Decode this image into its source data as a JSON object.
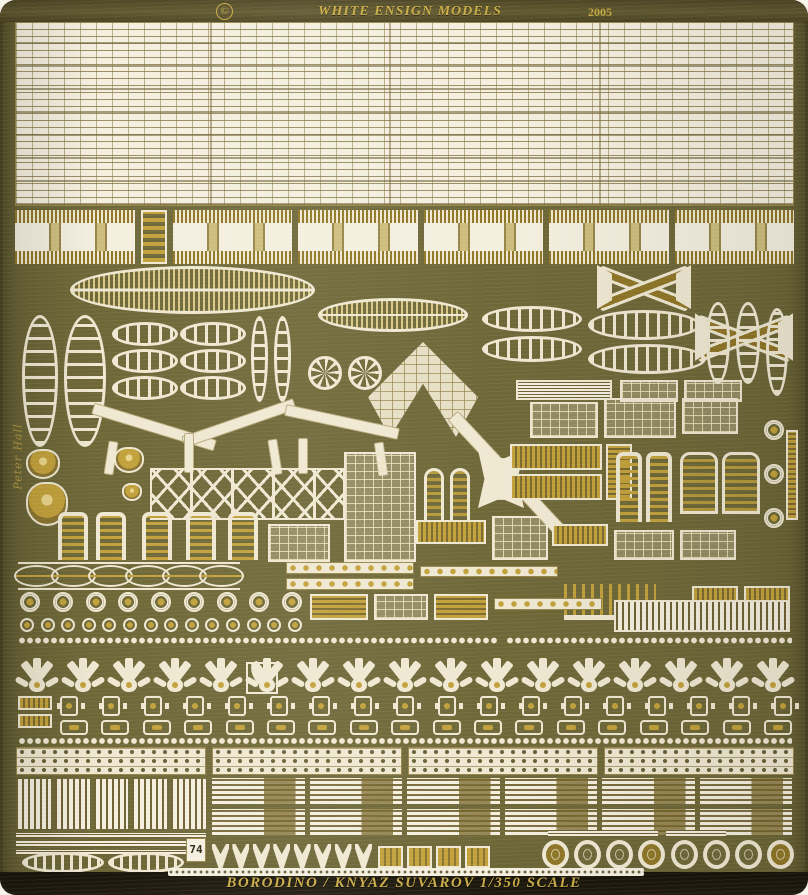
{
  "header": {
    "copyright": "©",
    "brand": "WHITE ENSIGN MODELS",
    "year": "2005"
  },
  "footer": {
    "caption": "BORODINO / KNYAZ SUVAROV  1/350 SCALE"
  },
  "markings": {
    "signature": "Peter Hall",
    "part_number": "74"
  },
  "colors": {
    "plate": "#6e6839",
    "plate_edge": "#554e2a",
    "cream": "#efe8d2",
    "gold": "#c2a13b",
    "gold_deep": "#8f7627",
    "header_band": "#5a5230",
    "footer_band": "#211b0e",
    "text_gold": "#c9ab45"
  }
}
